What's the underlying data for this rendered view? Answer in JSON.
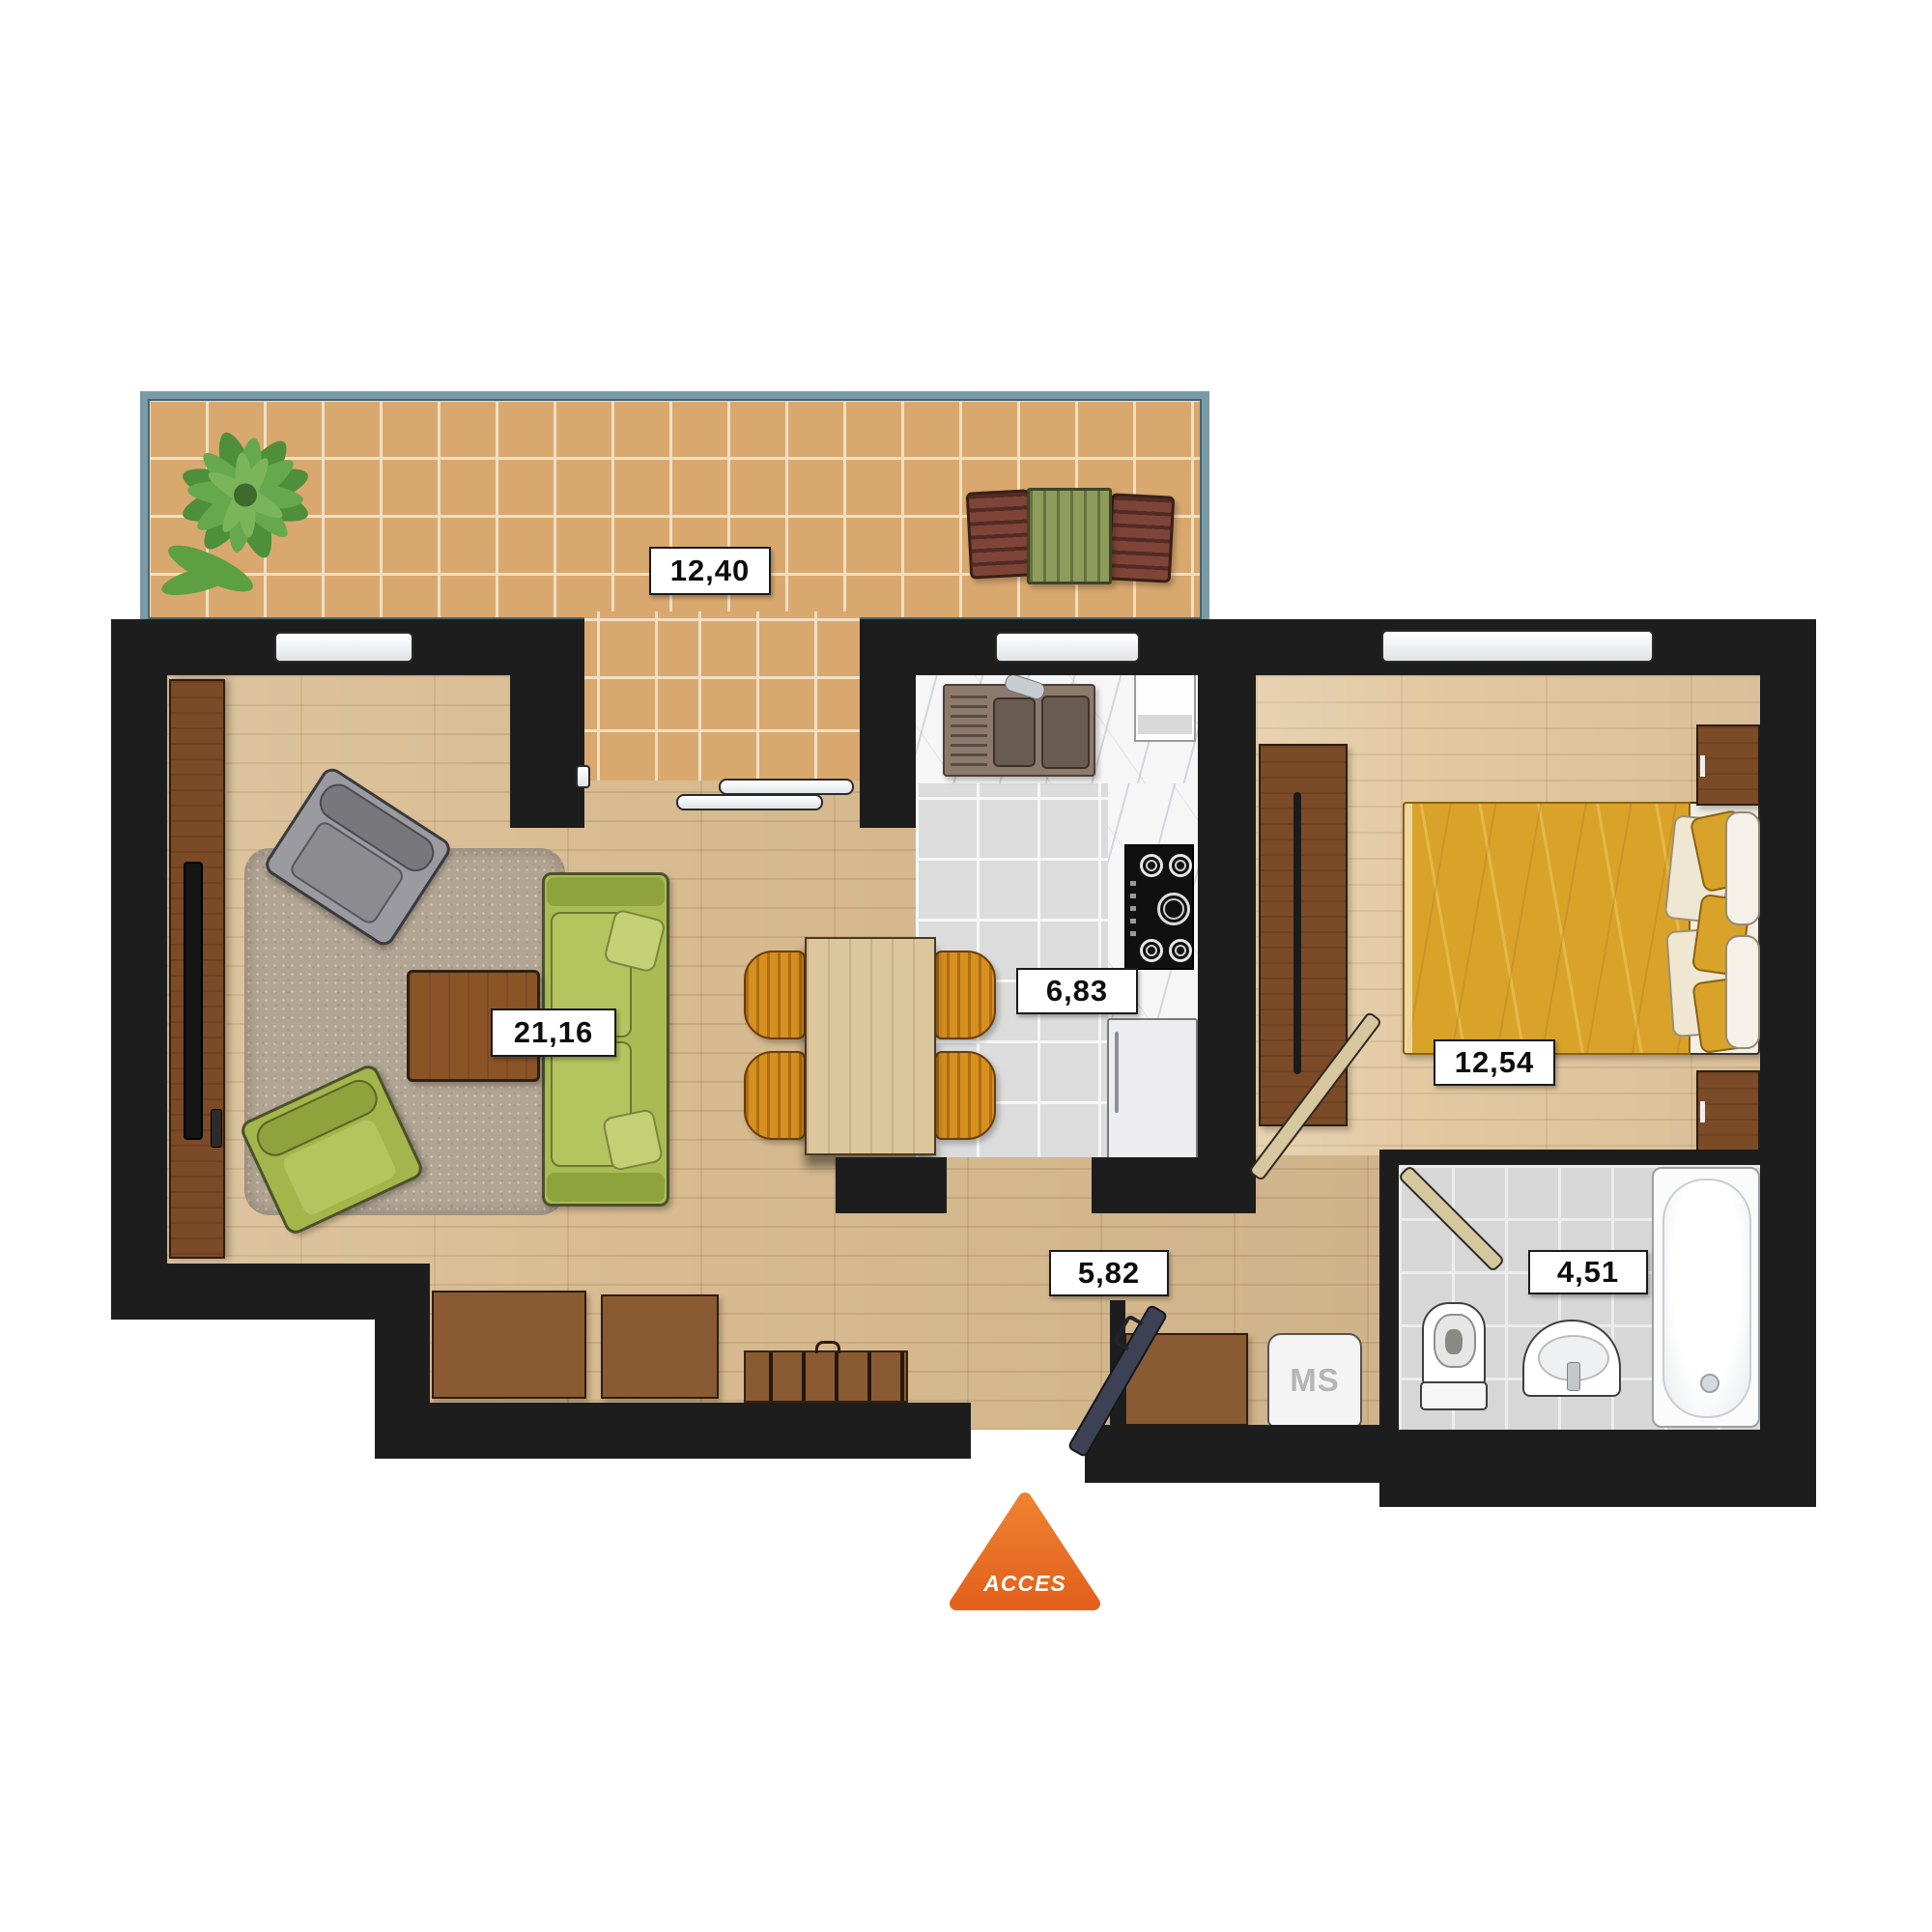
{
  "plan": {
    "type": "apartment-floor-plan",
    "rooms": [
      {
        "name": "terrace",
        "area_label": "12,40"
      },
      {
        "name": "living-room",
        "area_label": "21,16"
      },
      {
        "name": "kitchen",
        "area_label": "6,83"
      },
      {
        "name": "bedroom",
        "area_label": "12,54"
      },
      {
        "name": "hallway",
        "area_label": "5,82"
      },
      {
        "name": "bathroom",
        "area_label": "4,51"
      }
    ],
    "appliances": {
      "washing_machine_label": "MS"
    },
    "access": {
      "label": "ACCES",
      "color": "#e96f24"
    },
    "colors": {
      "wall": "#1d1d1d",
      "terrace_tile": "#d9a86f",
      "terrace_rail_teal": "#7a9aa6",
      "wood_floor": "#d8bb90",
      "bedroom_floor": "#e2c8a0",
      "kitchen_tile": "#dcdcdc",
      "bath_tile": "#d7d7d7",
      "sofa_green": "#a9bb52",
      "bed_yellow": "#d9a32a",
      "dining_chair_orange": "#d78f1e",
      "cabinet_brown": "#7b4a27",
      "accent_orange": "#e96f24"
    }
  }
}
